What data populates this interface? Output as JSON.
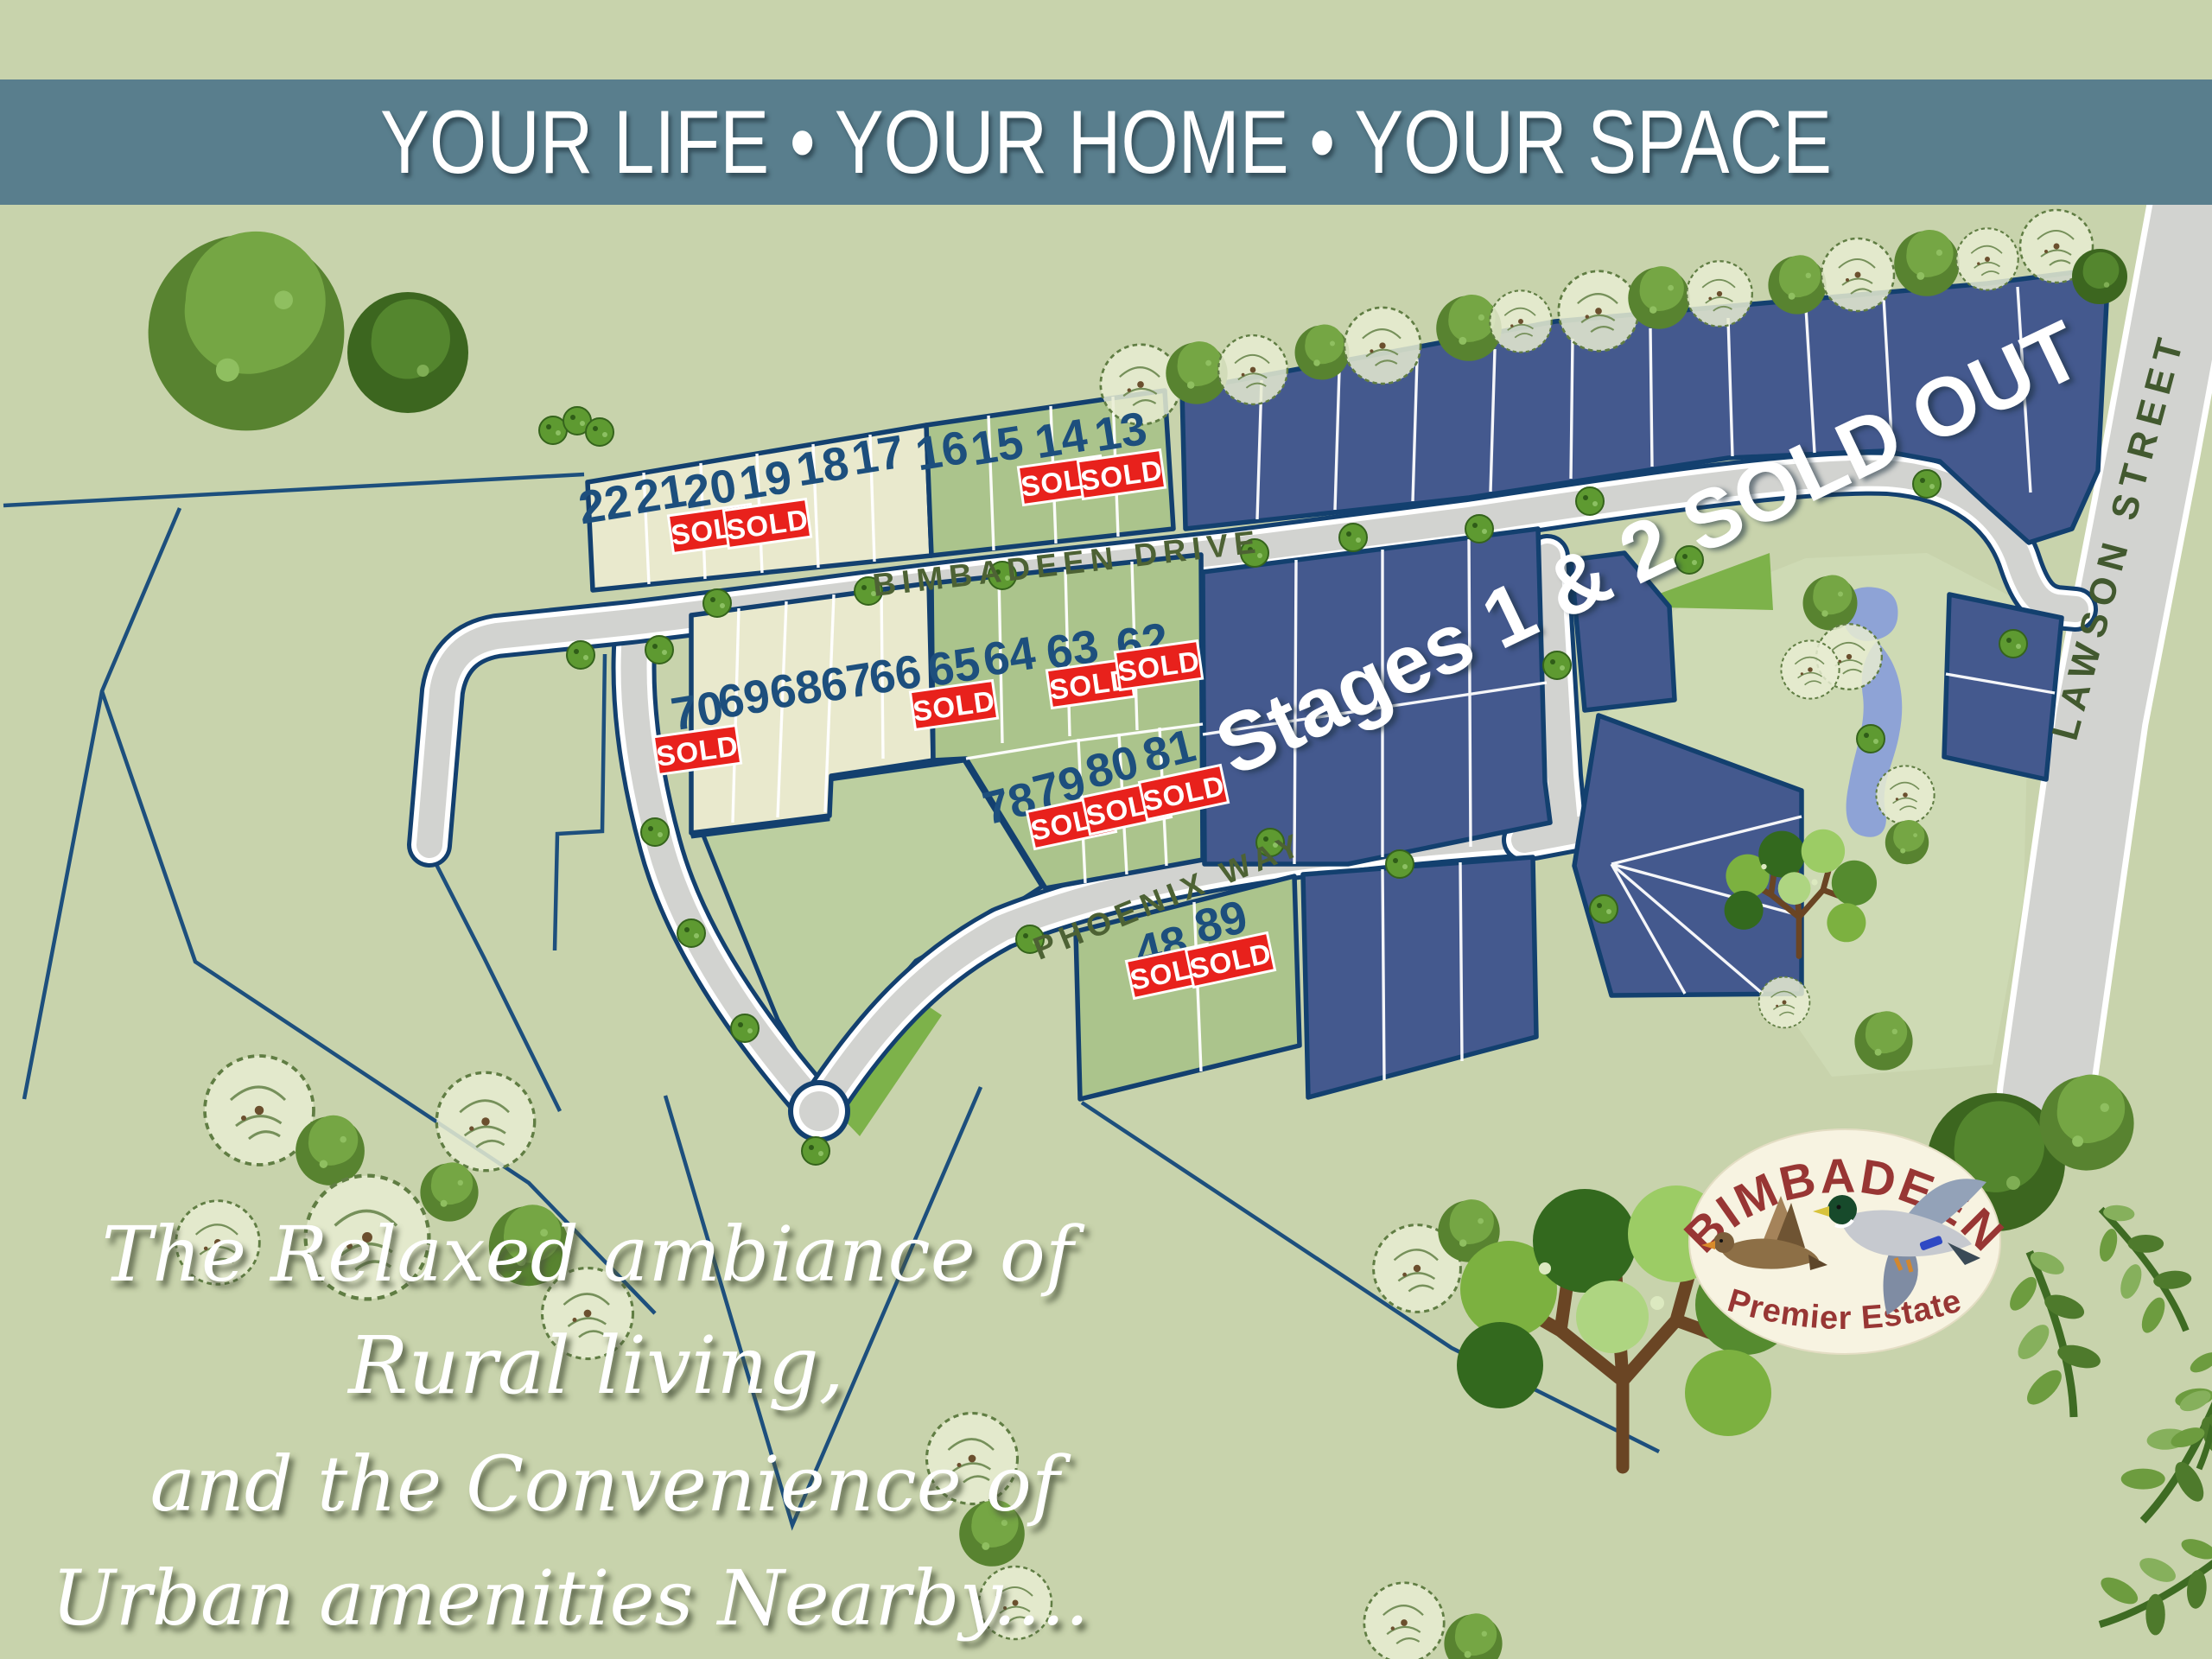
{
  "banner": {
    "title": "YOUR LIFE • YOUR HOME • YOUR SPACE"
  },
  "map": {
    "streets": {
      "bimbadeen": "BIMBADEEN DRIVE",
      "phoenix": "PHOENIX WAY",
      "lawson": "LAWSON STREET"
    },
    "stages_note": "Stages 1 & 2 SOLD OUT",
    "sold_label": "SOLD",
    "lots": [
      {
        "number": "22",
        "sold": false
      },
      {
        "number": "21",
        "sold": false
      },
      {
        "number": "20",
        "sold": true
      },
      {
        "number": "19",
        "sold": true
      },
      {
        "number": "18",
        "sold": false
      },
      {
        "number": "17",
        "sold": false
      },
      {
        "number": "16",
        "sold": false
      },
      {
        "number": "15",
        "sold": false
      },
      {
        "number": "14",
        "sold": true
      },
      {
        "number": "13",
        "sold": true
      },
      {
        "number": "70",
        "sold": true
      },
      {
        "number": "69",
        "sold": false
      },
      {
        "number": "68",
        "sold": false
      },
      {
        "number": "67",
        "sold": false
      },
      {
        "number": "66",
        "sold": false
      },
      {
        "number": "65",
        "sold": true
      },
      {
        "number": "64",
        "sold": false
      },
      {
        "number": "63",
        "sold": true
      },
      {
        "number": "62",
        "sold": true
      },
      {
        "number": "78",
        "sold": false
      },
      {
        "number": "79",
        "sold": true
      },
      {
        "number": "80",
        "sold": true
      },
      {
        "number": "81",
        "sold": true
      },
      {
        "number": "48",
        "sold": true
      },
      {
        "number": "89",
        "sold": true
      }
    ]
  },
  "logo": {
    "name": "BIMBADEEN",
    "tagline": "Premier Estate"
  },
  "tagline": {
    "line1": "The Relaxed ambiance of",
    "line2": "Rural living,",
    "line3": "and the Convenience of",
    "line4": "Urban amenities Nearby...."
  },
  "colors": {
    "banner_bg": "#597e8d",
    "background": "#c8d3ac",
    "stage_lot": "#44598e",
    "lot_border": "#13406f",
    "released_lot_cream": "#e9e9cd",
    "released_lot_green": "#abc48c",
    "sold_red": "#e8211c",
    "lot_number_navy": "#1d4f7d",
    "road_gray": "#d2d3d0",
    "pond_blue": "#8ea3d6"
  }
}
